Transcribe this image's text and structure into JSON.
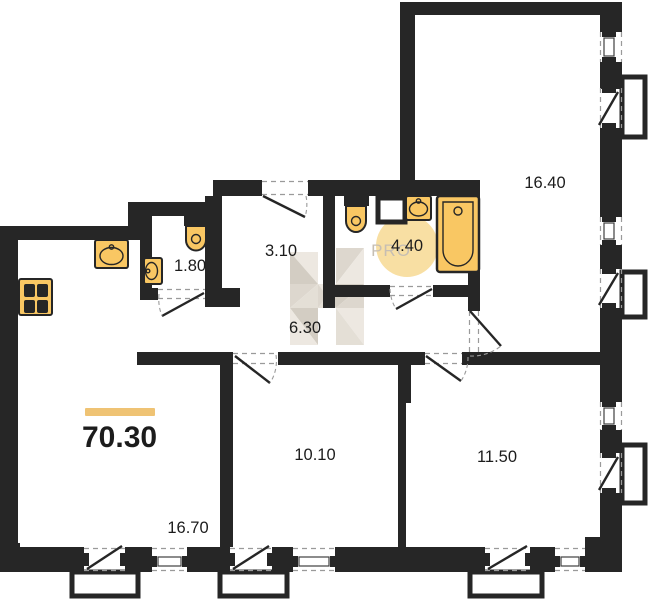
{
  "plan": {
    "title": "apartment-floor-plan",
    "total": {
      "area": "70.30"
    },
    "rooms": [
      {
        "name": "bedroom",
        "area": "16.40"
      },
      {
        "name": "wc",
        "area": "1.80"
      },
      {
        "name": "corridor",
        "area": "3.10"
      },
      {
        "name": "bathroom",
        "area": "4.40"
      },
      {
        "name": "hallway",
        "area": "6.30"
      },
      {
        "name": "room",
        "area": "10.10"
      },
      {
        "name": "room",
        "area": "11.50"
      },
      {
        "name": "living-kitchen",
        "area": "16.70"
      }
    ],
    "watermark": {
      "badge": "PRO",
      "logo": "h-letter"
    },
    "fixtures": [
      "kitchen-sink",
      "stove",
      "toilet",
      "wash-basin",
      "toilet",
      "wash-basin",
      "bathtub",
      "vent-shaft"
    ],
    "colors": {
      "wall": "#262626",
      "fixture": "#f9c763",
      "badge_fill": "#f8dfa3",
      "badge_text": "#c6beb3",
      "accent_bar": "#efc374",
      "label": "#1c1c1c",
      "dash": "#9a9a9a",
      "wm1": "#eae5dc",
      "wm2": "#d8d1c6",
      "wm3": "#ccc5b9",
      "wm4": "#e0dad0"
    }
  }
}
